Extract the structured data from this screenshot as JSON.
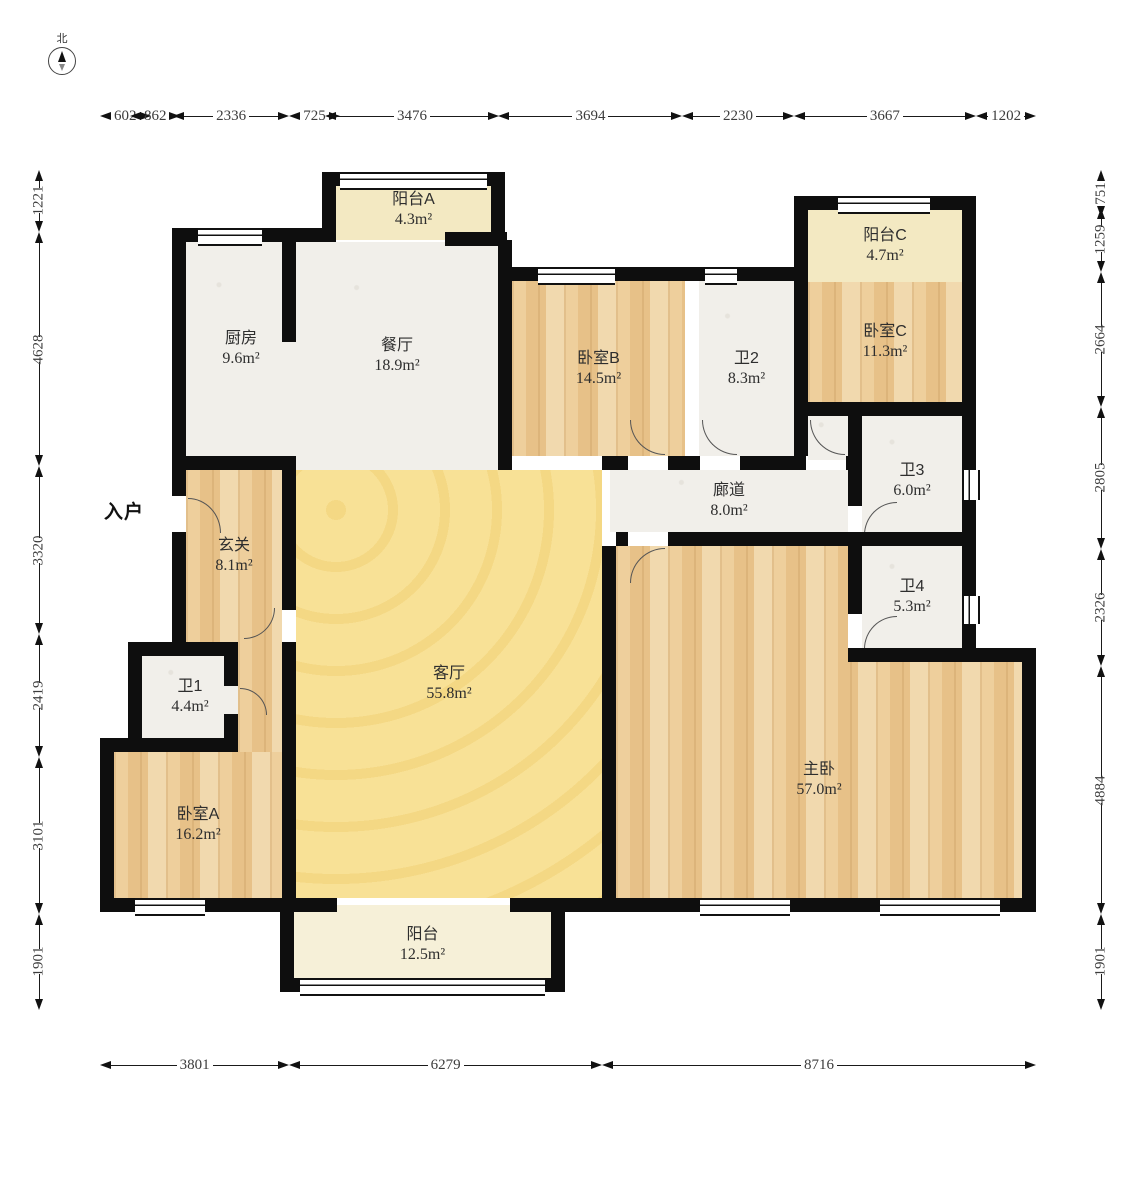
{
  "compass": {
    "label": "北"
  },
  "entry": {
    "label": "入户"
  },
  "rooms": [
    {
      "id": "balcony-a",
      "name": "阳台A",
      "area": "4.3m²"
    },
    {
      "id": "kitchen",
      "name": "厨房",
      "area": "9.6m²"
    },
    {
      "id": "dining",
      "name": "餐厅",
      "area": "18.9m²"
    },
    {
      "id": "bedroom-b",
      "name": "卧室B",
      "area": "14.5m²"
    },
    {
      "id": "bath-2",
      "name": "卫2",
      "area": "8.3m²"
    },
    {
      "id": "balcony-c",
      "name": "阳台C",
      "area": "4.7m²"
    },
    {
      "id": "bedroom-c",
      "name": "卧室C",
      "area": "11.3m²"
    },
    {
      "id": "bath-3",
      "name": "卫3",
      "area": "6.0m²"
    },
    {
      "id": "corridor",
      "name": "廊道",
      "area": "8.0m²"
    },
    {
      "id": "foyer",
      "name": "玄关",
      "area": "8.1m²"
    },
    {
      "id": "bath-4",
      "name": "卫4",
      "area": "5.3m²"
    },
    {
      "id": "living",
      "name": "客厅",
      "area": "55.8m²"
    },
    {
      "id": "bath-1",
      "name": "卫1",
      "area": "4.4m²"
    },
    {
      "id": "bedroom-a",
      "name": "卧室A",
      "area": "16.2m²"
    },
    {
      "id": "master",
      "name": "主卧",
      "area": "57.0m²"
    },
    {
      "id": "balcony-s",
      "name": "阳台",
      "area": "12.5m²"
    }
  ],
  "dimensions": {
    "top": [
      602,
      862,
      2336,
      725,
      3476,
      3694,
      2230,
      3667,
      1202
    ],
    "bottom": [
      3801,
      6279,
      8716
    ],
    "left": [
      1221,
      4628,
      3320,
      2419,
      3101,
      1901
    ],
    "right": [
      751,
      1259,
      2664,
      2805,
      2326,
      4884,
      1901
    ]
  },
  "colors": {
    "wall": "#0e0e0e",
    "wood_floor": "#e9c48c",
    "living_yellow": "#f8e196",
    "balcony_cream": "#f3e9c2",
    "tile_white": "#f1efea",
    "dimension_text": "#3c3c3c"
  }
}
